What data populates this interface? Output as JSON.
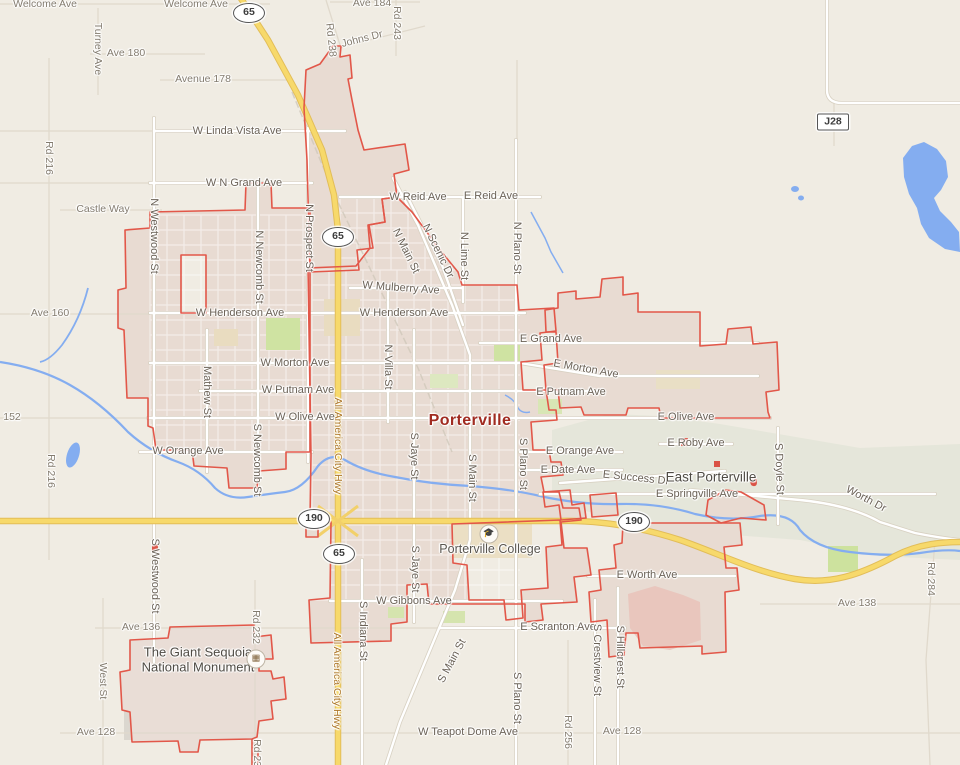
{
  "map": {
    "city_name": "Porterville",
    "colors": {
      "background": "#f0ece3",
      "city_fill": "#e8dbd2",
      "city_border": "#e25749",
      "highway_yellow": "#f7d96b",
      "highway_casing": "#e2bd58",
      "water": "#84adf0",
      "foothill": "#e3e6d8",
      "park_green": "#cfe3a2",
      "campus_tan": "#ebdfc4"
    },
    "shields": [
      {
        "n": "65",
        "x": 249,
        "y": 13,
        "sq": false
      },
      {
        "n": "65",
        "x": 338,
        "y": 237,
        "sq": false
      },
      {
        "n": "65",
        "x": 339,
        "y": 554,
        "sq": false
      },
      {
        "n": "190",
        "x": 314,
        "y": 519,
        "sq": false
      },
      {
        "n": "190",
        "x": 634,
        "y": 522,
        "sq": false
      },
      {
        "n": "J28",
        "x": 833,
        "y": 122,
        "sq": true
      }
    ],
    "pois": [
      {
        "k": "college-icon",
        "glyph": "🎓",
        "x": 489,
        "y": 534
      },
      {
        "k": "monument-icon",
        "glyph": "▦",
        "x": 256,
        "y": 659
      }
    ],
    "labels": [
      {
        "t": "Welcome Ave",
        "x": 45,
        "y": 4,
        "c": "sm"
      },
      {
        "t": "Welcome Ave",
        "x": 196,
        "y": 4,
        "c": "sm"
      },
      {
        "t": "Ave 184",
        "x": 372,
        "y": 3,
        "c": "sm"
      },
      {
        "t": "Rd 243",
        "x": 397,
        "y": 23,
        "r": 90,
        "c": "sm"
      },
      {
        "t": "Johns Dr",
        "x": 362,
        "y": 39,
        "r": -14,
        "c": "sm"
      },
      {
        "t": "Rd 238",
        "x": 331,
        "y": 40,
        "r": 84,
        "c": "sm"
      },
      {
        "t": "Turney Ave",
        "x": 98,
        "y": 49,
        "r": 90,
        "c": "sm"
      },
      {
        "t": "Ave 180",
        "x": 126,
        "y": 53,
        "c": "sm"
      },
      {
        "t": "Avenue 178",
        "x": 203,
        "y": 79,
        "c": "sm"
      },
      {
        "t": "W Linda Vista Ave",
        "x": 237,
        "y": 131
      },
      {
        "t": "Rd 216",
        "x": 49,
        "y": 158,
        "r": 90,
        "c": "sm"
      },
      {
        "t": "W N Grand Ave",
        "x": 244,
        "y": 183
      },
      {
        "t": "Castle Way",
        "x": 103,
        "y": 209,
        "c": "sm"
      },
      {
        "t": "N Westwood St",
        "x": 154,
        "y": 236,
        "r": 90
      },
      {
        "t": "W Reid Ave",
        "x": 418,
        "y": 197
      },
      {
        "t": "E Reid Ave",
        "x": 491,
        "y": 196
      },
      {
        "t": "N Prospect St",
        "x": 309,
        "y": 238,
        "r": 90
      },
      {
        "t": "N Newcomb St",
        "x": 259,
        "y": 267,
        "r": 90
      },
      {
        "t": "N Main St",
        "x": 406,
        "y": 251,
        "r": 64
      },
      {
        "t": "N Scenic Dr",
        "x": 438,
        "y": 251,
        "r": 64
      },
      {
        "t": "N Lime St",
        "x": 464,
        "y": 256,
        "r": 90
      },
      {
        "t": "N Plano St",
        "x": 517,
        "y": 248,
        "r": 90
      },
      {
        "t": "W Mulberry Ave",
        "x": 401,
        "y": 288,
        "r": 4
      },
      {
        "t": "W Henderson Ave",
        "x": 240,
        "y": 313
      },
      {
        "t": "W Henderson Ave",
        "x": 404,
        "y": 313
      },
      {
        "t": "Ave 160",
        "x": 50,
        "y": 313,
        "c": "sm"
      },
      {
        "t": "E Grand Ave",
        "x": 551,
        "y": 339
      },
      {
        "t": "W Morton Ave",
        "x": 295,
        "y": 363
      },
      {
        "t": "E Morton Ave",
        "x": 586,
        "y": 369,
        "r": 10
      },
      {
        "t": "Mathew St",
        "x": 207,
        "y": 392,
        "r": 90
      },
      {
        "t": "W Putnam Ave",
        "x": 298,
        "y": 390
      },
      {
        "t": "E Putnam Ave",
        "x": 571,
        "y": 392
      },
      {
        "t": "N Villa St",
        "x": 388,
        "y": 367,
        "r": 90
      },
      {
        "t": "152",
        "x": 12,
        "y": 417,
        "c": "sm"
      },
      {
        "t": "W Olive Ave",
        "x": 305,
        "y": 417
      },
      {
        "t": "Porterville",
        "x": 470,
        "y": 421,
        "c": "city"
      },
      {
        "t": "E Olive Ave",
        "x": 686,
        "y": 417
      },
      {
        "t": "E Roby Ave",
        "x": 696,
        "y": 443
      },
      {
        "t": "W Orange Ave",
        "x": 188,
        "y": 451
      },
      {
        "t": "E Orange Ave",
        "x": 580,
        "y": 451
      },
      {
        "t": "S Newcomb St",
        "x": 257,
        "y": 460,
        "r": 90
      },
      {
        "t": "All America City Hwy",
        "x": 338,
        "y": 446,
        "r": 90,
        "c": "hwy"
      },
      {
        "t": "S Jaye St",
        "x": 414,
        "y": 456,
        "r": 90
      },
      {
        "t": "Rd 216",
        "x": 51,
        "y": 471,
        "r": 90,
        "c": "sm"
      },
      {
        "t": "E Date Ave",
        "x": 568,
        "y": 470
      },
      {
        "t": "E Success Dr",
        "x": 636,
        "y": 478,
        "r": 6
      },
      {
        "t": "East Porterville",
        "x": 711,
        "y": 477,
        "c": "loc"
      },
      {
        "t": "S Main St",
        "x": 472,
        "y": 478,
        "r": 90
      },
      {
        "t": "S Plano St",
        "x": 523,
        "y": 464,
        "r": 90
      },
      {
        "t": "S Doyle St",
        "x": 779,
        "y": 469,
        "r": 88
      },
      {
        "t": "E Springville Ave",
        "x": 697,
        "y": 494
      },
      {
        "t": "Worth Dr",
        "x": 866,
        "y": 499,
        "r": 28
      },
      {
        "t": "Porterville College",
        "x": 490,
        "y": 549,
        "c": "poi"
      },
      {
        "t": "S Westwood St",
        "x": 155,
        "y": 576,
        "r": 90
      },
      {
        "t": "E Worth Ave",
        "x": 647,
        "y": 575
      },
      {
        "t": "S Jaye St",
        "x": 415,
        "y": 569,
        "r": 90
      },
      {
        "t": "W Gibbons Ave",
        "x": 414,
        "y": 601
      },
      {
        "t": "Rd 284",
        "x": 931,
        "y": 579,
        "r": 90,
        "c": "sm"
      },
      {
        "t": "Ave 138",
        "x": 857,
        "y": 603,
        "c": "sm"
      },
      {
        "t": "E Scranton Ave",
        "x": 558,
        "y": 627
      },
      {
        "t": "S Crestview St",
        "x": 597,
        "y": 660,
        "r": 90
      },
      {
        "t": "S Hillcrest St",
        "x": 620,
        "y": 657,
        "r": 90
      },
      {
        "t": "Ave 136",
        "x": 141,
        "y": 627,
        "c": "sm"
      },
      {
        "t": "Rd 232",
        "x": 256,
        "y": 627,
        "r": 90,
        "c": "sm"
      },
      {
        "t": "The Giant Sequoia\nNational Monument",
        "x": 198,
        "y": 660,
        "c": "mon"
      },
      {
        "t": "S Indiana St",
        "x": 363,
        "y": 631,
        "r": 90
      },
      {
        "t": "West St",
        "x": 103,
        "y": 681,
        "r": 90,
        "c": "sm"
      },
      {
        "t": "S Main St",
        "x": 452,
        "y": 661,
        "r": -62
      },
      {
        "t": "All America City Hwy",
        "x": 337,
        "y": 681,
        "r": 90,
        "c": "hwy"
      },
      {
        "t": "S Plano St",
        "x": 517,
        "y": 698,
        "r": 90
      },
      {
        "t": "Rd 256",
        "x": 568,
        "y": 732,
        "r": 90,
        "c": "sm"
      },
      {
        "t": "W Teapot Dome Ave",
        "x": 468,
        "y": 732
      },
      {
        "t": "Ave 128",
        "x": 96,
        "y": 732,
        "c": "sm"
      },
      {
        "t": "Ave 128",
        "x": 622,
        "y": 731,
        "c": "sm"
      },
      {
        "t": "Rd 232",
        "x": 257,
        "y": 756,
        "r": 90,
        "c": "sm"
      }
    ]
  }
}
